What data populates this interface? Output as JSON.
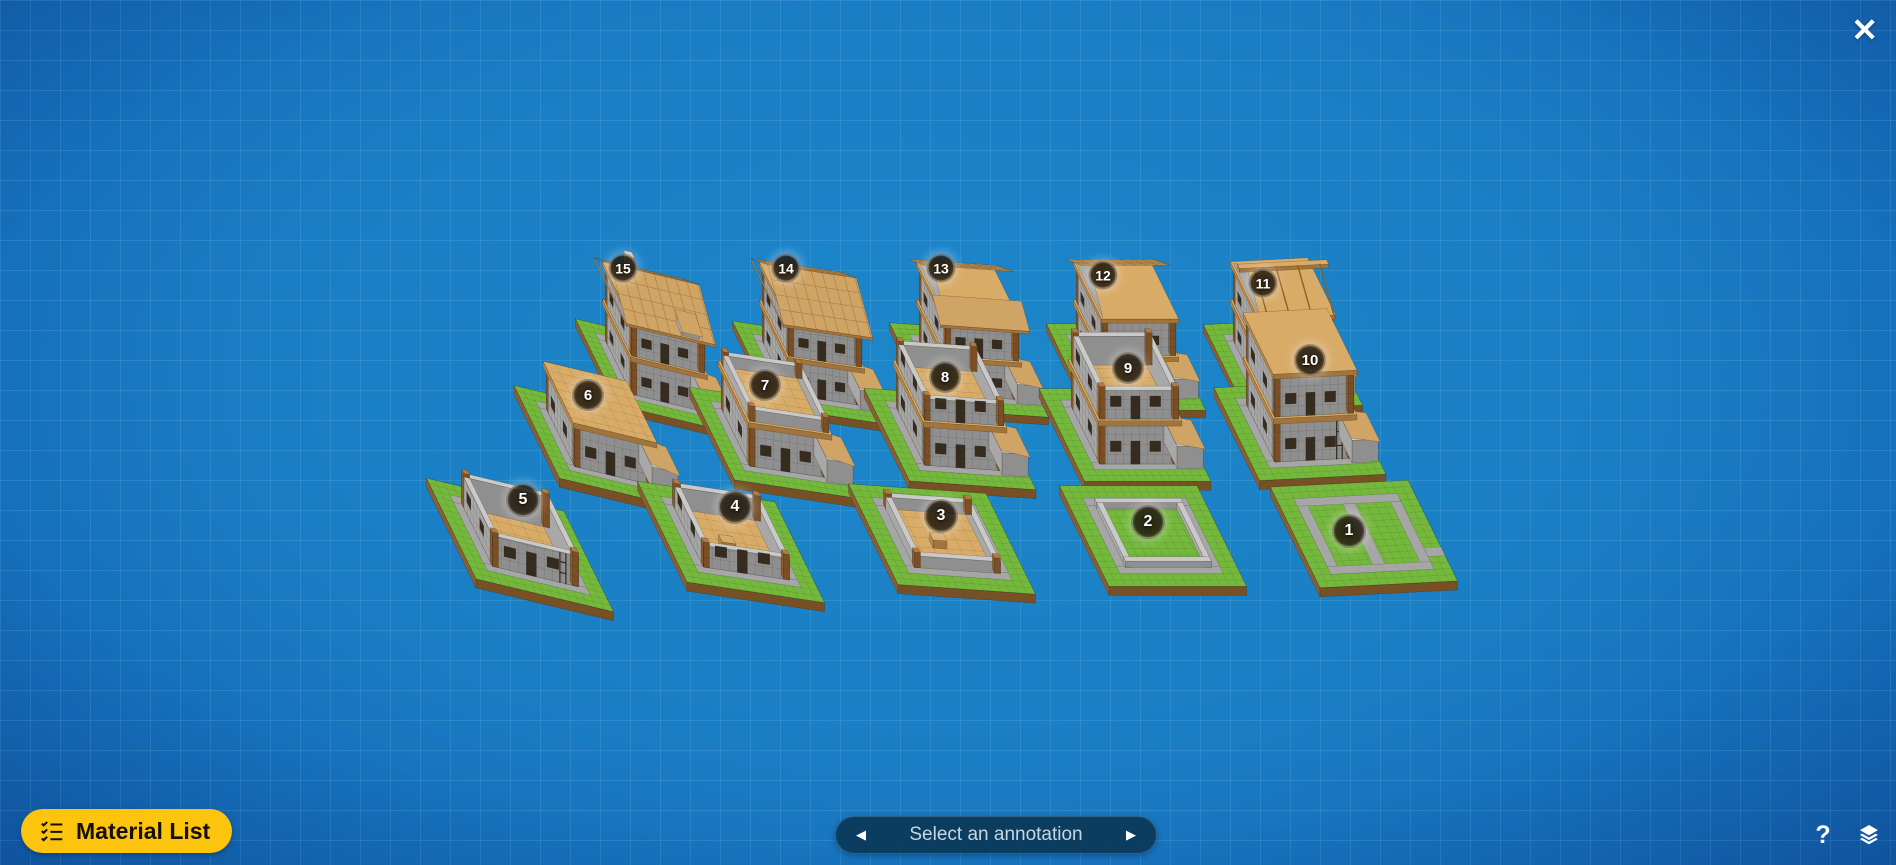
{
  "window": {
    "close_icon": "✕"
  },
  "toolbar": {
    "material_list_label": "Material List",
    "button_color": "#fdc40e"
  },
  "annotation_nav": {
    "label": "Select an annotation",
    "prev_icon": "◀",
    "next_icon": "▶",
    "background": "#0a3858"
  },
  "footer": {
    "help_label": "?"
  },
  "scene": {
    "annotation_count": 15,
    "annotations": [
      {
        "num": "1",
        "row": 2,
        "x": 1349,
        "y": 531
      },
      {
        "num": "2",
        "row": 2,
        "x": 1148,
        "y": 522
      },
      {
        "num": "3",
        "row": 2,
        "x": 941,
        "y": 516
      },
      {
        "num": "4",
        "row": 2,
        "x": 735,
        "y": 507
      },
      {
        "num": "5",
        "row": 2,
        "x": 523,
        "y": 500
      },
      {
        "num": "6",
        "row": 1,
        "x": 588,
        "y": 395
      },
      {
        "num": "7",
        "row": 1,
        "x": 765,
        "y": 385
      },
      {
        "num": "8",
        "row": 1,
        "x": 945,
        "y": 377
      },
      {
        "num": "9",
        "row": 1,
        "x": 1128,
        "y": 368
      },
      {
        "num": "10",
        "row": 1,
        "x": 1310,
        "y": 360
      },
      {
        "num": "11",
        "row": 0,
        "x": 1263,
        "y": 283
      },
      {
        "num": "12",
        "row": 0,
        "x": 1103,
        "y": 275
      },
      {
        "num": "13",
        "row": 0,
        "x": 941,
        "y": 268
      },
      {
        "num": "14",
        "row": 0,
        "x": 786,
        "y": 268
      },
      {
        "num": "15",
        "row": 0,
        "x": 623,
        "y": 268
      }
    ],
    "rows": [
      {
        "ub": 7.3,
        "vx": 2.65,
        "vy": 5.4,
        "zc": 7.7
      },
      {
        "ub": 7.9,
        "vx": 2.85,
        "vy": 5.8,
        "zc": 9.0
      },
      {
        "ub": 8.6,
        "vx": 3.1,
        "vy": 6.3,
        "zc": 9.0
      }
    ],
    "u_slope_by_col": [
      0.24,
      0.15,
      0.07,
      0.0,
      -0.05
    ],
    "stages": [
      {
        "num": 15,
        "row": 0,
        "col": 0,
        "cx": 655,
        "cy": 376
      },
      {
        "num": 14,
        "row": 0,
        "col": 1,
        "cx": 812,
        "cy": 373
      },
      {
        "num": 13,
        "row": 0,
        "col": 2,
        "cx": 969,
        "cy": 370
      },
      {
        "num": 12,
        "row": 0,
        "col": 3,
        "cx": 1126,
        "cy": 367
      },
      {
        "num": 11,
        "row": 0,
        "col": 4,
        "cx": 1283,
        "cy": 365
      },
      {
        "num": 6,
        "row": 1,
        "col": 0,
        "cx": 600,
        "cy": 447
      },
      {
        "num": 7,
        "row": 1,
        "col": 1,
        "cx": 775,
        "cy": 443
      },
      {
        "num": 8,
        "row": 1,
        "col": 2,
        "cx": 950,
        "cy": 439
      },
      {
        "num": 9,
        "row": 1,
        "col": 3,
        "cx": 1125,
        "cy": 435
      },
      {
        "num": 10,
        "row": 1,
        "col": 4,
        "cx": 1300,
        "cy": 431
      },
      {
        "num": 5,
        "row": 2,
        "col": 0,
        "cx": 520,
        "cy": 545
      },
      {
        "num": 4,
        "row": 2,
        "col": 1,
        "cx": 731,
        "cy": 542
      },
      {
        "num": 3,
        "row": 2,
        "col": 2,
        "cx": 942,
        "cy": 539
      },
      {
        "num": 2,
        "row": 2,
        "col": 3,
        "cx": 1153,
        "cy": 536
      },
      {
        "num": 1,
        "row": 2,
        "col": 4,
        "cx": 1364,
        "cy": 534
      }
    ],
    "builds": {
      "1": {
        "pathCross": true
      },
      "2": {
        "w1": 0.7
      },
      "3": {
        "floor": true,
        "w1": 1.3,
        "table": true
      },
      "4": {
        "floor": true,
        "w1": 2.4,
        "table": true
      },
      "5": {
        "floor": true,
        "w1": 3.4,
        "table": true,
        "ladder": true
      },
      "6": {
        "floor": true,
        "w1": 4.4,
        "slab1": true,
        "annex": true
      },
      "7": {
        "floor": true,
        "w1": 4.4,
        "slab1": true,
        "annex": true,
        "w2": 1.3
      },
      "8": {
        "floor": true,
        "w1": 4.4,
        "slab1": true,
        "annex": true,
        "w2": 2.4
      },
      "9": {
        "floor": true,
        "w1": 4.4,
        "slab1": true,
        "annex": true,
        "w2": 3.2
      },
      "10": {
        "floor": true,
        "w1": 4.4,
        "slab1": true,
        "annex": true,
        "w2": 4.4,
        "slab2": true,
        "ladder": true
      },
      "11": {
        "w1": 4.4,
        "slab1": true,
        "annex": true,
        "w2": 4.4,
        "slab2": true,
        "gable": true,
        "ridge": true
      },
      "12": {
        "w1": 4.4,
        "slab1": true,
        "annex": true,
        "w2": 4.4,
        "slab2": true,
        "gable": true,
        "roofBack": true
      },
      "13": {
        "w1": 4.4,
        "slab1": true,
        "annex": true,
        "w2": 4.4,
        "slab2": true,
        "gable": true,
        "roofBack": true,
        "roofFrontPartial": true
      },
      "14": {
        "w1": 4.4,
        "slab1": true,
        "annex": true,
        "w2": 4.4,
        "slab2": true,
        "roofBack": true,
        "roofFront": true
      },
      "15": {
        "w1": 4.4,
        "slab1": true,
        "annex": true,
        "w2": 4.4,
        "slab2": true,
        "roofBack": true,
        "roofFront": true,
        "dormer": true,
        "chimney": true
      }
    },
    "palette": {
      "grass_top": "#74b83c",
      "dirt_left": "#8a5e33",
      "dirt_front": "#775026",
      "path": "#a6a6a6",
      "stone_top": "#c9c9c9",
      "stone_left": "#a8a8a8",
      "stone_front": "#8f8f8f",
      "wood_top": "#d8ab67",
      "wood_left": "#b8874a",
      "wood_front": "#a1743c",
      "post_top": "#b07c42",
      "post_left": "#8f5e2c",
      "post_front": "#7a4f25",
      "roof_front": "#cfa464",
      "roof_back": "#b98e4f",
      "dark": "#352b1e"
    }
  }
}
